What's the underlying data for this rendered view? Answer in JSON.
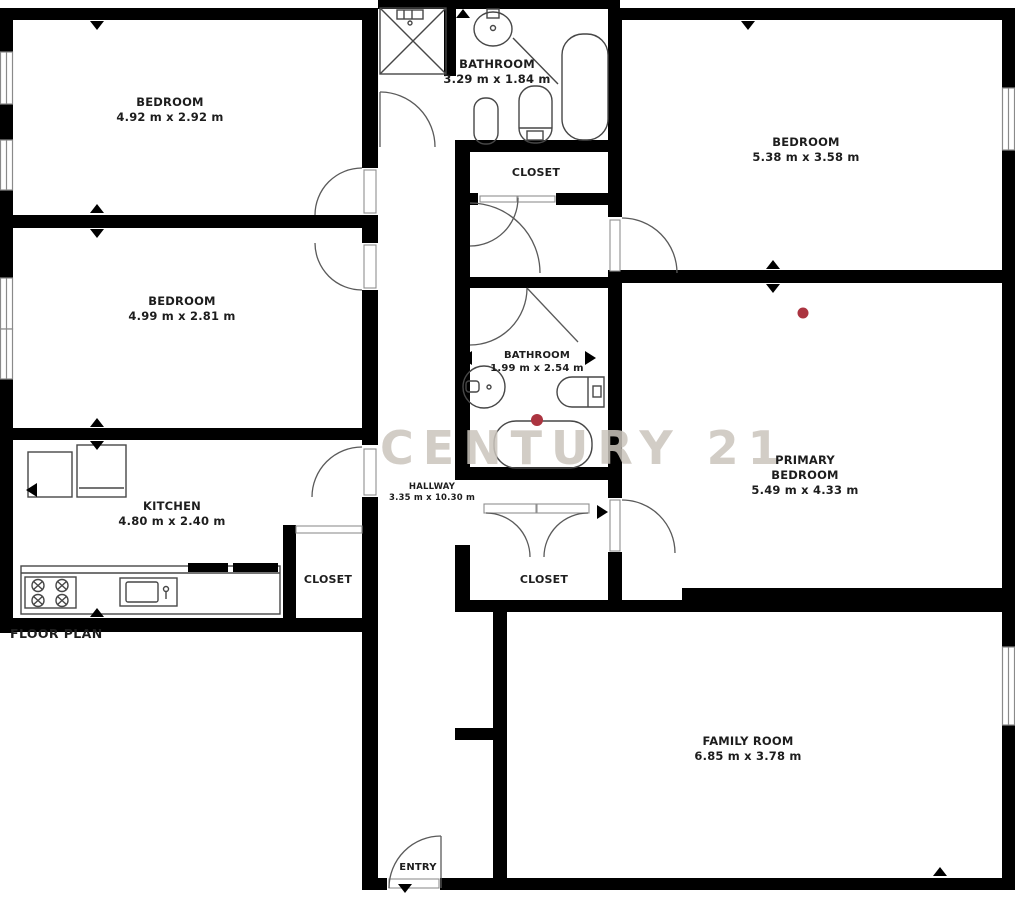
{
  "title": "FLOOR PLAN",
  "watermark": "CENTURY 21",
  "colors": {
    "wall": "#000000",
    "fixture_line": "#4a4a4a",
    "red_dot": "#ab3440",
    "watermark": "#cbc5bd",
    "label_text": "#1d1d1d"
  },
  "rooms": [
    {
      "id": "bedroom-top-left",
      "name": "BEDROOM",
      "dims": "4.92 m x 2.92 m"
    },
    {
      "id": "bathroom-top",
      "name": "BATHROOM",
      "dims": "3.29 m x 1.84 m"
    },
    {
      "id": "bedroom-top-right",
      "name": "BEDROOM",
      "dims": "5.38 m x 3.58 m"
    },
    {
      "id": "closet-top",
      "name": "CLOSET"
    },
    {
      "id": "bedroom-mid-left",
      "name": "BEDROOM",
      "dims": "4.99 m x 2.81 m"
    },
    {
      "id": "bathroom-mid",
      "name": "BATHROOM",
      "dims": "1.99 m x 2.54 m"
    },
    {
      "id": "primary-bedroom",
      "name": "PRIMARY",
      "name2": "BEDROOM",
      "dims": "5.49 m x 4.33 m"
    },
    {
      "id": "kitchen",
      "name": "KITCHEN",
      "dims": "4.80 m x 2.40 m"
    },
    {
      "id": "hallway",
      "name": "HALLWAY",
      "dims": "3.35 m x 10.30 m"
    },
    {
      "id": "closet-kitchen",
      "name": "CLOSET"
    },
    {
      "id": "closet-mid",
      "name": "CLOSET"
    },
    {
      "id": "family-room",
      "name": "FAMILY ROOM",
      "dims": "6.85 m x 3.78 m"
    },
    {
      "id": "entry",
      "name": "ENTRY"
    }
  ]
}
